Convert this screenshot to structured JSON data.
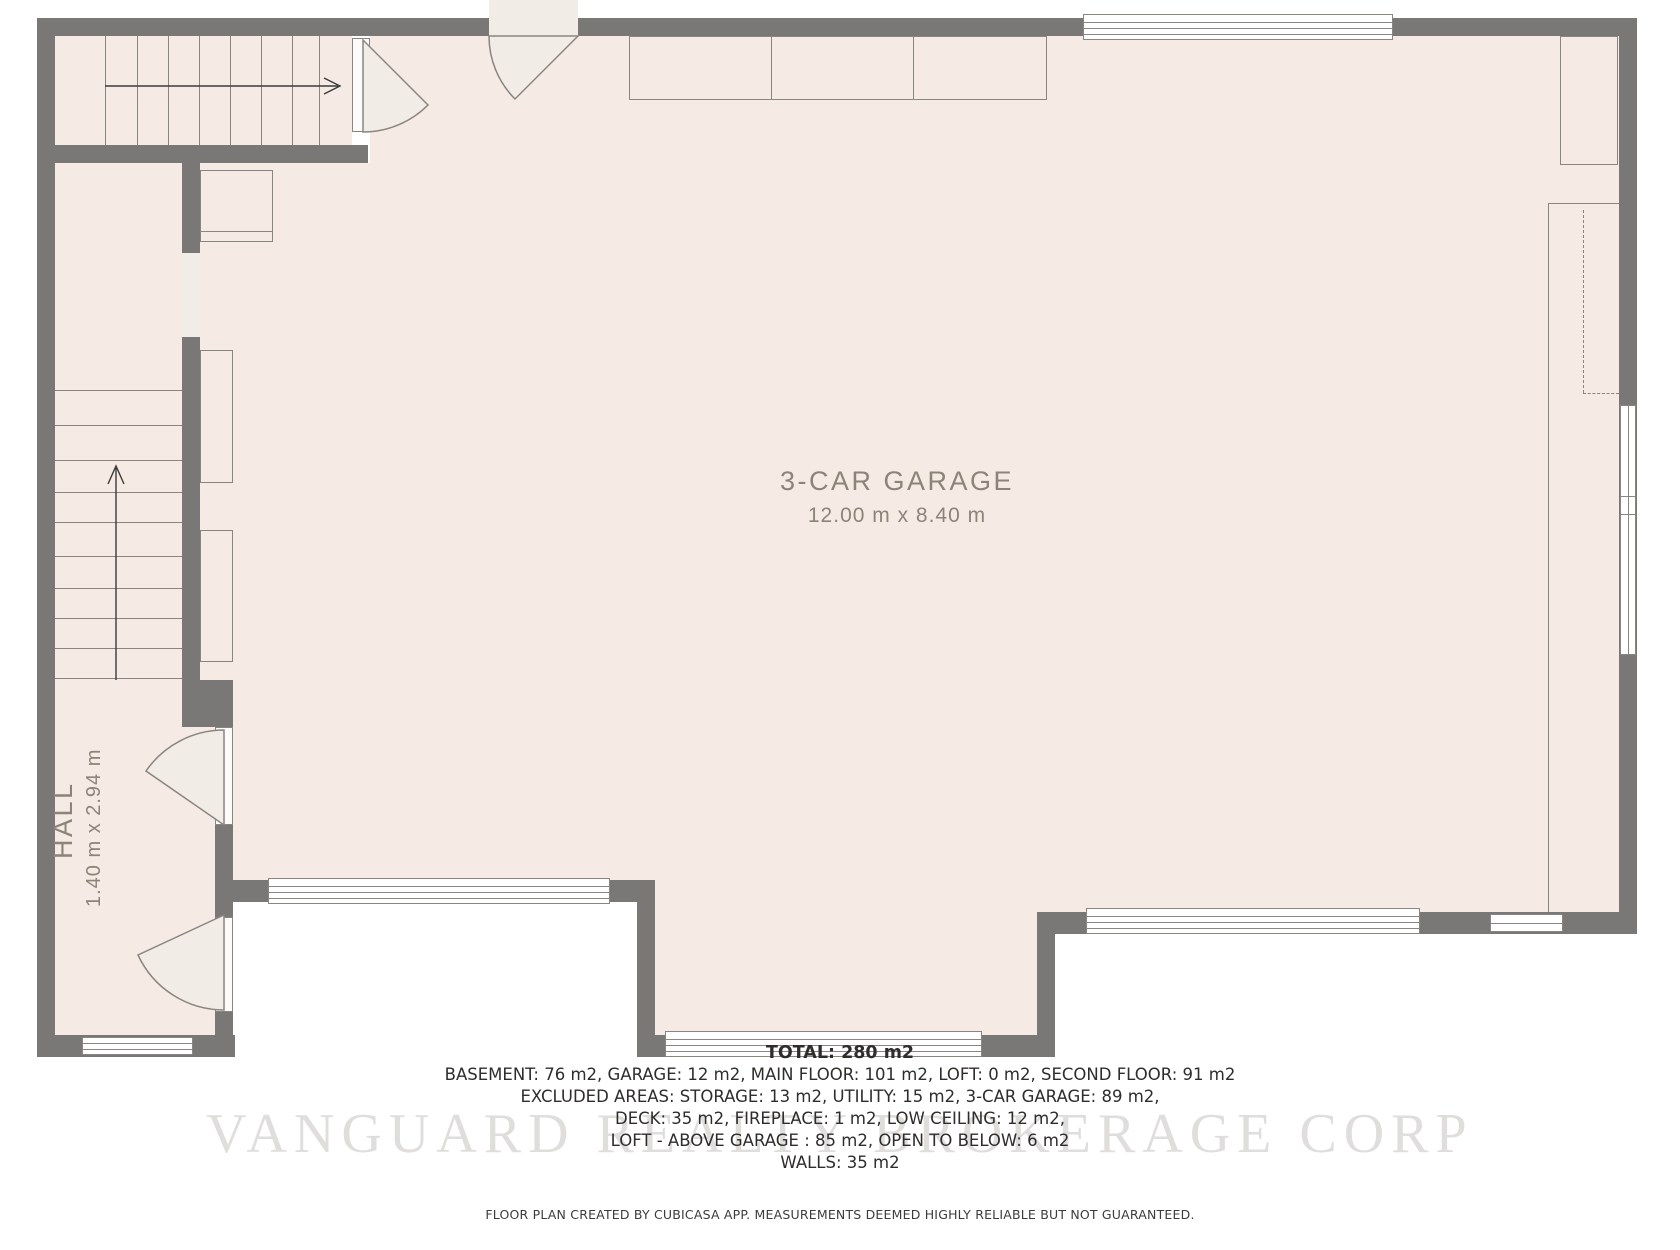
{
  "colors": {
    "wall": "#7a7876",
    "floor": "#f6ebe4",
    "line": "#8a8580",
    "label": "#8b8479",
    "text": "#2e2d2c"
  },
  "rooms": {
    "garage": {
      "name": "3-CAR GARAGE",
      "dims": "12.00 m x 8.40 m"
    },
    "hall": {
      "name": "HALL",
      "dims": "1.40 m x 2.94 m"
    }
  },
  "summary": {
    "total": "TOTAL: 280 m2",
    "lines": [
      "BASEMENT: 76 m2, GARAGE: 12 m2, MAIN FLOOR: 101 m2, LOFT: 0 m2, SECOND FLOOR: 91 m2",
      "EXCLUDED AREAS: STORAGE: 13 m2, UTILITY: 15 m2, 3-CAR GARAGE: 89 m2,",
      "DECK: 35 m2, FIREPLACE: 1 m2, LOW CEILING: 12 m2,",
      "LOFT - ABOVE GARAGE : 85 m2, OPEN TO BELOW: 6 m2",
      "WALLS: 35 m2"
    ]
  },
  "disclaimer": "FLOOR PLAN CREATED BY CUBICASA APP. MEASUREMENTS DEEMED HIGHLY RELIABLE BUT NOT GUARANTEED.",
  "watermark": "VANGUARD REALTY BROKERAGE CORP"
}
